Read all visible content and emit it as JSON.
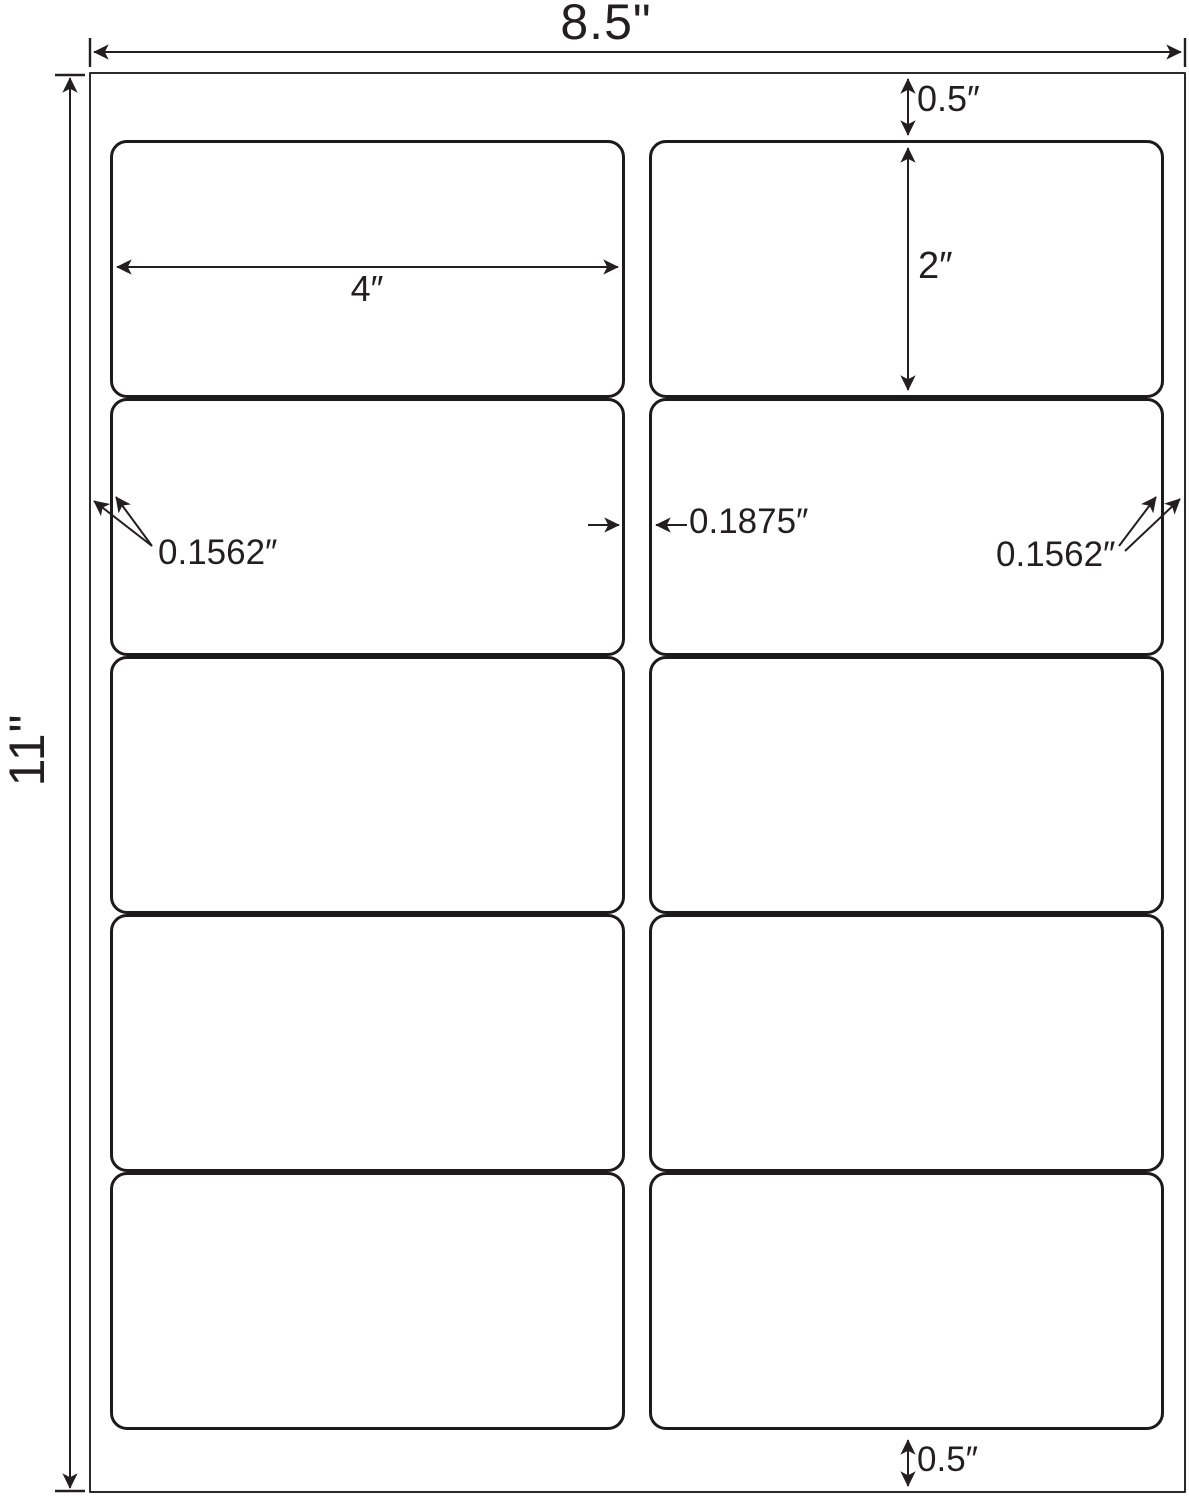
{
  "diagram": {
    "grid": {
      "rows": 5,
      "columns": 2
    },
    "dims": {
      "sheet_width": "8.5\"",
      "sheet_height": "11\"",
      "top_margin": "0.5″",
      "bottom_margin": "0.5″",
      "left_margin": "0.1562″",
      "right_margin": "0.1562″",
      "center_gap": "0.1875″",
      "label_width": "4″",
      "label_height": "2″"
    },
    "colors": {
      "line": "#231f20",
      "label_border": "#1d1a1b",
      "sheet_border": "#2e2a2b",
      "background": "#ffffff"
    }
  }
}
